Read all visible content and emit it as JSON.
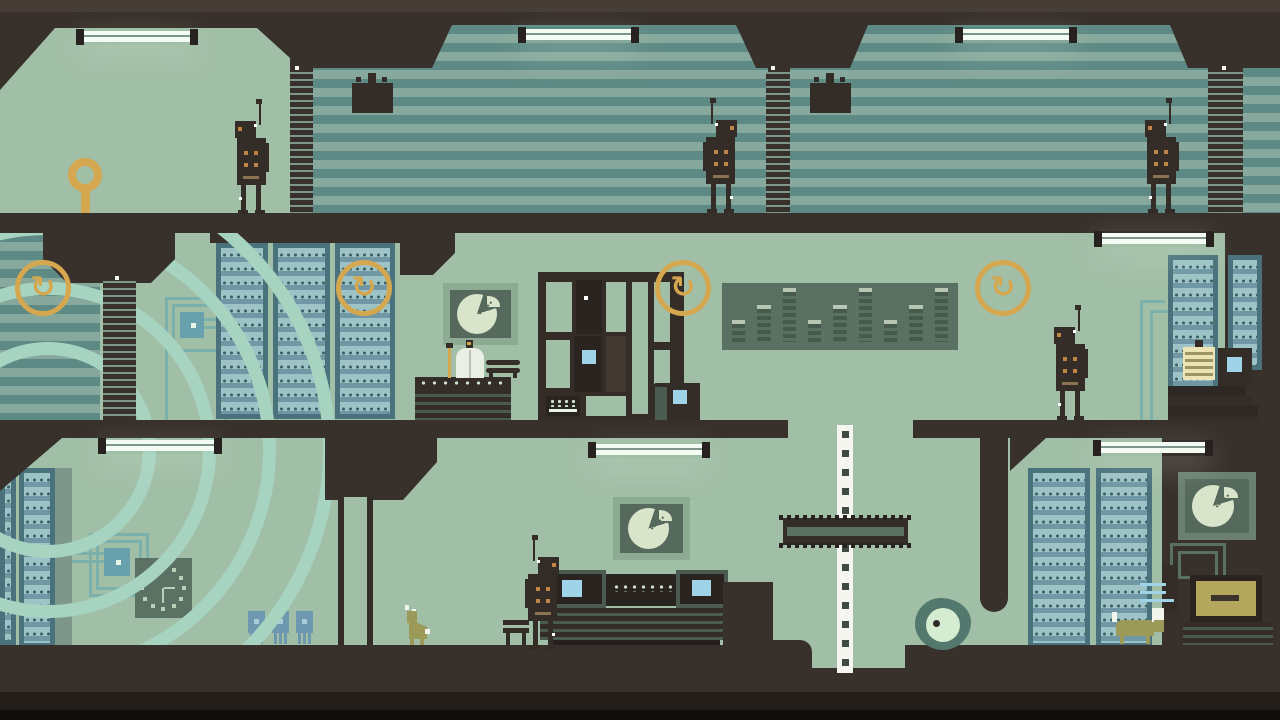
{
  "meta": {
    "description": "Pixel-art side-view game scene: three-storey research facility with striped walls, server racks, patrolling robots, consoles and creatures",
    "visible_text": []
  },
  "palette": {
    "bg_dark": "#38302b",
    "bg_top_band": "#473d36",
    "bracket_dark": "#272220",
    "ground_strip": "#241e1b",
    "ground_black": "#100d0c",
    "room_green": "#a1bea6",
    "stripe_light": "#87a89c",
    "stripe_dark": "#5e8a85",
    "pillar_stripe": "#7e968c",
    "arc_mint": "#a7d3c1",
    "rack_frame": "#49727c",
    "rack_panel": "#6f98a4",
    "rack_tray": "#9dc3c6",
    "rack_dot": "#3c5f68",
    "trace_teal": "#7cb0ab",
    "chip_teal": "#69a0ad",
    "accent_ochre": "#d5a74f",
    "accent_orange": "#c08447",
    "accent_dim": "#8a7450",
    "light_tube": "#f4fbf2",
    "screen_blue": "#9fd4e8",
    "panel_sage": "#5a7062",
    "eq_bar": "#46594d",
    "eq_cap": "#b8c7b3",
    "pie_frame": "#8cab92",
    "pie_frame_dark": "#6b8070",
    "pie_panel": "#55695c",
    "pie_fill": "#d9e5ca",
    "clock_body": "#5b7164",
    "clock_mark": "#bdcdb7",
    "sprite_dark": "#342c27",
    "rib_light": "#4a5c51",
    "creature_body": "#53796e",
    "creature_eye": "#d6ecd1",
    "animal_olive": "#9c9a58",
    "monitor_olive": "#b2a75c",
    "component_blue": "#6d98b0",
    "figure_white": "#eaeee4",
    "pole_white": "#f4f6ef"
  },
  "icons": {
    "swap_glyph": "↻",
    "swap_icon_count": 4,
    "key_marker": "lollipop-ring"
  },
  "scene": {
    "floors": [
      "upper-corridor",
      "server-hall",
      "lab-basement"
    ],
    "robots": [
      "patrol-robot-1",
      "patrol-robot-2",
      "patrol-robot-3",
      "patrol-robot-4",
      "console-robot"
    ],
    "creatures": [
      "dog",
      "eyeball-blob",
      "cat"
    ],
    "rack_rows": 12,
    "equalizer_bars": [
      1,
      2,
      3,
      1,
      2,
      3,
      1,
      2,
      3
    ],
    "clock": {
      "hour_marks": 12,
      "hands": [
        "six",
        "three"
      ]
    },
    "pie_gauges": 3,
    "lights": 7
  }
}
